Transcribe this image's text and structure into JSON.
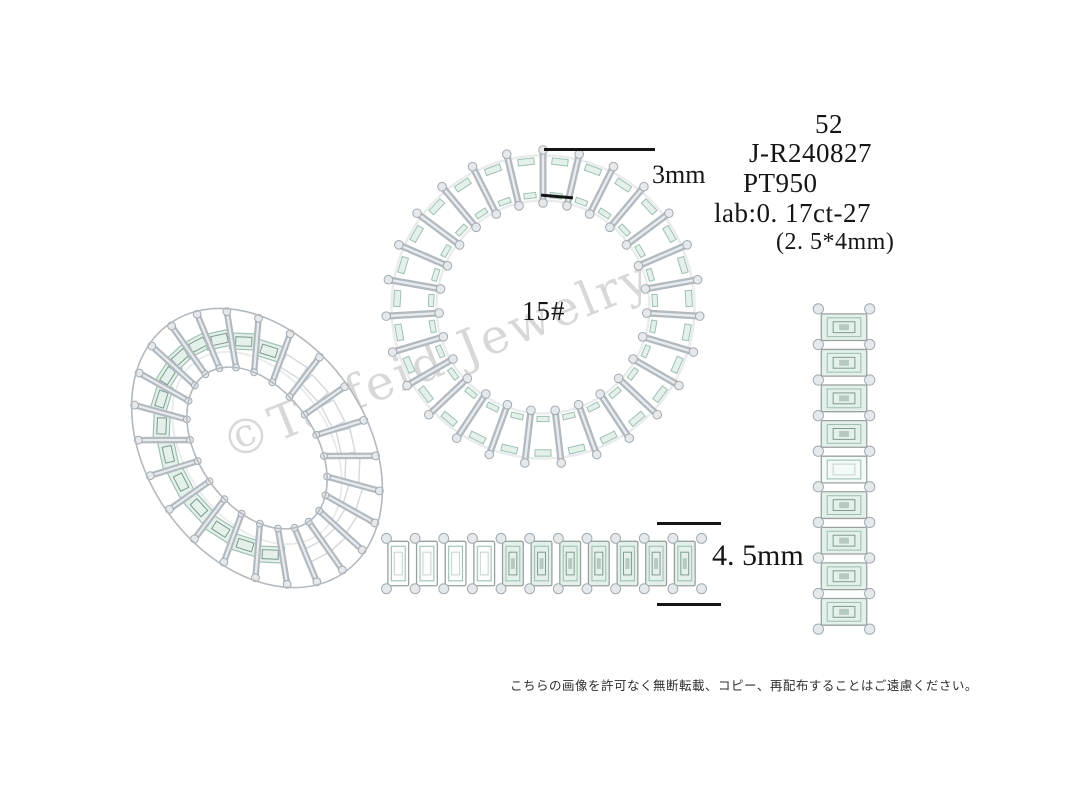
{
  "page": {
    "width": 1080,
    "height": 810,
    "background": "#ffffff"
  },
  "spec": {
    "size_eu": "52",
    "model_number": "J-R240827",
    "metal": "PT950",
    "stone_info": "lab:0. 17ct-27",
    "stone_dimensions": "(2. 5*4mm)"
  },
  "annotations": {
    "ring_size_mark": "15#",
    "band_width": "3mm",
    "band_height": "4. 5mm"
  },
  "watermark": {
    "text": "©Taifeid Jewelry",
    "color": "#ababab"
  },
  "footer": {
    "notice": "こちらの画像を許可なく無断転載、コピー、再配布することはご遠慮ください。"
  },
  "views": {
    "perspective": {
      "prong_count": 24,
      "stone_count": 14
    },
    "top": {
      "prong_count": 27
    },
    "side": {
      "stone_count": 11
    },
    "front": {
      "stone_count": 9
    }
  },
  "colors": {
    "text": "#151515",
    "dimension_line": "#151515",
    "metal_outline": "#a3aab0",
    "metal_mid": "#b2b9bf",
    "metal_light": "#e9ecee",
    "metal_bead": "#e6e9eb",
    "stone_fill": "#e4f1ea",
    "stone_fill_pale": "#f4faf7",
    "stone_edge": "#9fc0b2",
    "stone_deep": "#7e9a8d"
  }
}
